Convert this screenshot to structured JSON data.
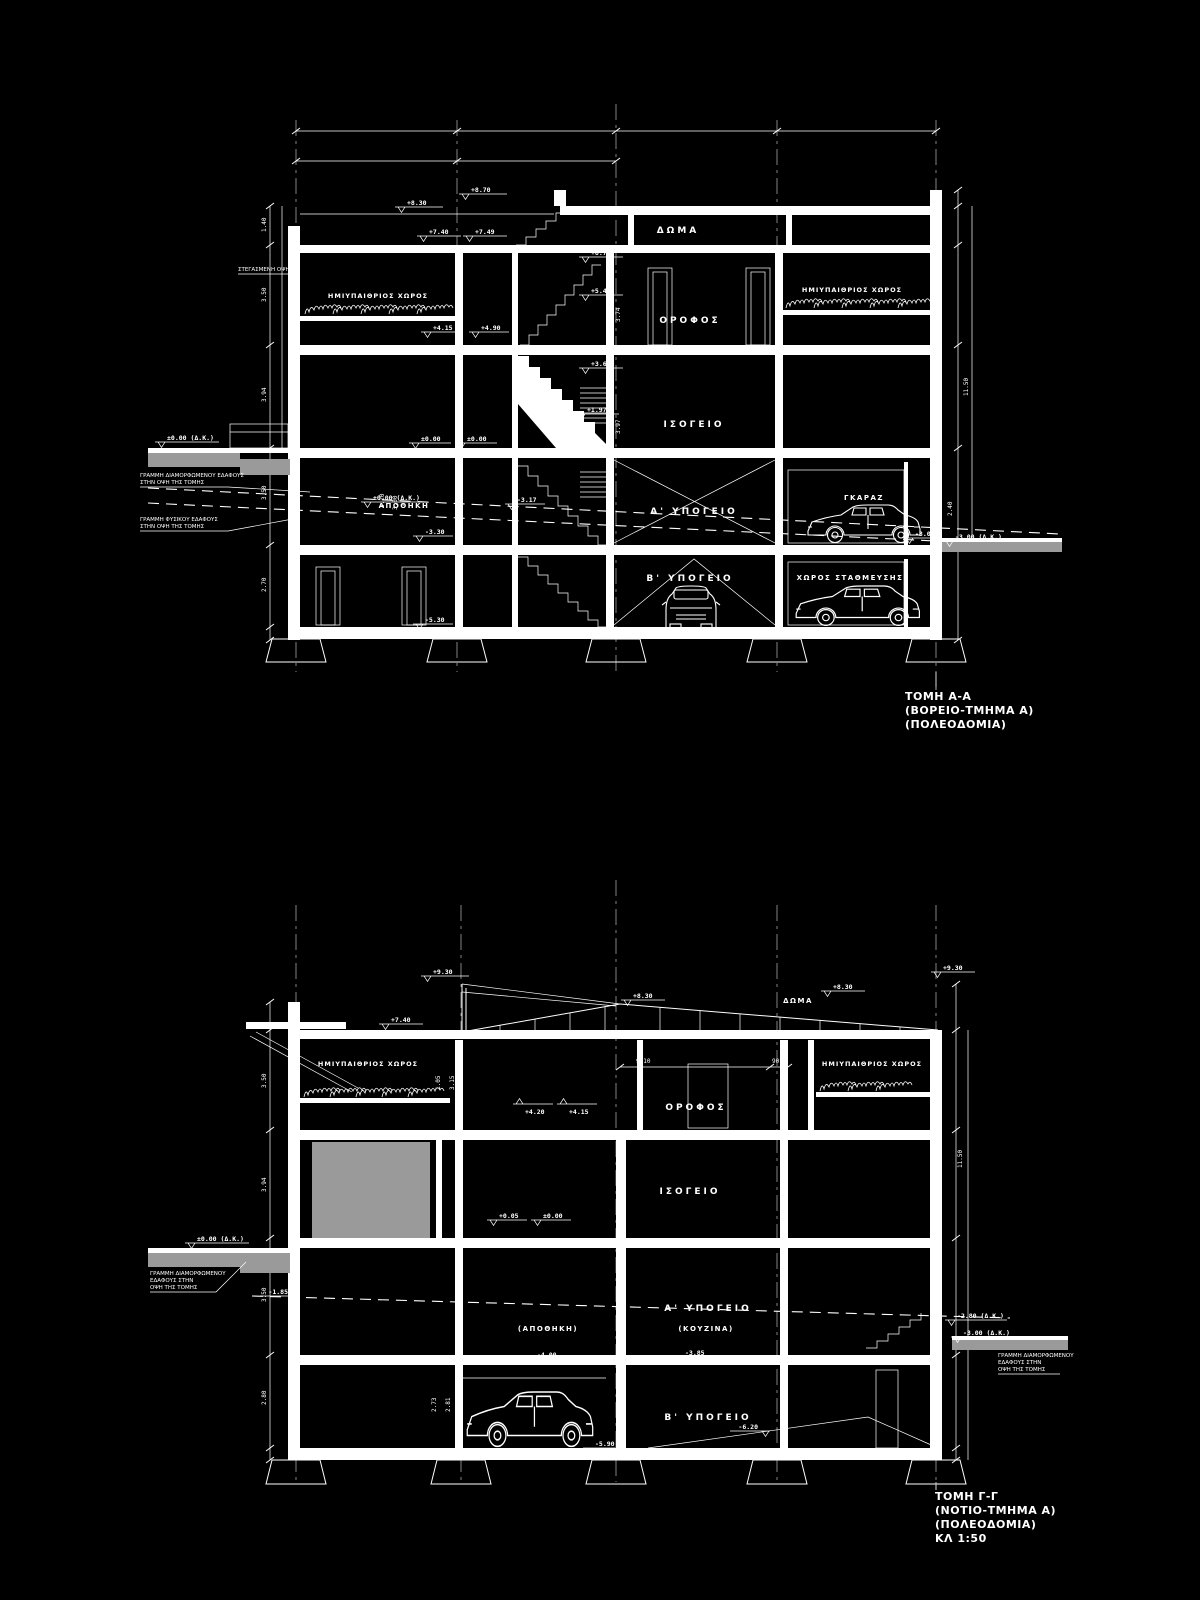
{
  "drawing": {
    "colors": {
      "background": "#000000",
      "line": "#ffffff",
      "gray": "#9a9a9a"
    },
    "section_a": {
      "title": [
        "ΤΟΜΗ Α-Α",
        "(ΒΟΡΕΙΟ-ΤΜΗΜΑ Α)",
        "(ΠΟΛΕΟΔΟΜΙΑ)"
      ],
      "labels": {
        "doma": "ΔΩΜΑ",
        "orofos": "ΟΡΟΦΟΣ",
        "isogeio": "ΙΣΟΓΕΙΟ",
        "ypogeio_a": "Α' ΥΠΟΓΕΙΟ",
        "ypogeio_b": "Β' ΥΠΟΓΕΙΟ",
        "apothiki": "ΑΠΟΘΗΚΗ",
        "garage": "ΓΚΑΡΑΖ",
        "parking": "ΧΩΡΟΣ ΣΤΑΘΜΕΥΣΗΣ",
        "semi_left": "ΗΜΙΥΠΑΙΘΡΙΟΣ ΧΩΡΟΣ",
        "semi_right": "ΗΜΙΥΠΑΙΘΡΙΟΣ ΧΩΡΟΣ",
        "covered_note": "ΣΤΕΓΑΣΜΕΝΗ ΟΨΗ"
      },
      "elev": {
        "p870": "+8.70",
        "p830": "+8.30",
        "p740": "+7.40",
        "p749": "+7.49",
        "p677": "+6.77",
        "p549": "+5.49",
        "p490": "+4.90",
        "p415": "+4.15",
        "p366": "+3.66",
        "p197": "+1.97",
        "z1": "±0.00",
        "z2": "±0.00",
        "zdk1": "±0.00 (Δ.Κ.)",
        "zdk2": "±0.00 (Δ.Κ.)",
        "m317": "-3.17",
        "m330": "-3.30",
        "m530": "-5.30",
        "m300": "-3.00",
        "m300dk": "-3.00 (Δ.Κ.)"
      },
      "dims": {
        "a": "3.74",
        "b": "3.97",
        "c": "3.00",
        "d": "3.20",
        "e": "3.00",
        "f": "2.40",
        "g": "11.50",
        "h": "1.40",
        "i": "3.50",
        "j": "3.94",
        "k": "3.50",
        "l": "2.70"
      },
      "ann": {
        "formed": [
          "ΓΡΑΜΜΗ ΔΙΑΜΟΡΦΩΜΕΝΟΥ ΕΔΑΦΟΥΣ",
          "ΣΤΗΝ ΟΨΗ ΤΗΣ ΤΟΜΗΣ"
        ],
        "natural": [
          "ΓΡΑΜΜΗ ΦΥΣΙΚΟΥ ΕΔΑΦΟΥΣ",
          "ΣΤΗΝ ΟΨΗ ΤΗΣ ΤΟΜΗΣ"
        ]
      }
    },
    "section_c": {
      "title": [
        "ΤΟΜΗ Γ-Γ",
        "(ΝΟΤΙΟ-ΤΜΗΜΑ Α)",
        "(ΠΟΛΕΟΔΟΜΙΑ)",
        "ΚΛ 1:50"
      ],
      "labels": {
        "doma": "ΔΩΜΑ",
        "orofos": "ΟΡΟΦΟΣ",
        "isogeio": "ΙΣΟΓΕΙΟ",
        "ypogeio_a": "Α' ΥΠΟΓΕΙΟ",
        "ypogeio_b": "Β' ΥΠΟΓΕΙΟ",
        "apothiki": "(ΑΠΟΘΗΚΗ)",
        "kouzina": "(ΚΟΥΖΙΝΑ)",
        "semi_left": "ΗΜΙΥΠΑΙΘΡΙΟΣ ΧΩΡΟΣ",
        "semi_right": "ΗΜΙΥΠΑΙΘΡΙΟΣ ΧΩΡΟΣ"
      },
      "elev": {
        "p930": "+9.30",
        "p830": "+8.30",
        "p830r": "+8.30",
        "p930r": "+9.30",
        "p740": "+7.40",
        "p420": "+4.20",
        "p415": "+4.15",
        "p005": "+0.05",
        "z1": "±0.00",
        "zdk": "±0.00 (Δ.Κ.)",
        "m185": "-1.85",
        "m400": "-4.00",
        "m385": "-3.85",
        "m280dk": "-2.80 (Δ.Κ.)",
        "m300dk": "-3.00 (Δ.Κ.)",
        "m620": "-6.20",
        "m590": "-5.90"
      },
      "dims": {
        "a": "9.10",
        "b": "90",
        "c": "1.05",
        "d": "3.15",
        "e": "2.73",
        "f": "2.81",
        "g": "11.50",
        "h": "3.50",
        "i": "3.94",
        "j": "3.50",
        "k": "2.80"
      },
      "ann": {
        "left": [
          "ΓΡΑΜΜΗ ΔΙΑΜΟΡΦΩΜΕΝΟΥ",
          "ΕΔΑΦΟΥΣ ΣΤΗΝ",
          "ΟΨΗ ΤΗΣ ΤΟΜΗΣ"
        ],
        "right": [
          "ΓΡΑΜΜΗ ΔΙΑΜΟΡΦΩΜΕΝΟΥ",
          "ΕΔΑΦΟΥΣ ΣΤΗΝ",
          "ΟΨΗ ΤΗΣ ΤΟΜΗΣ"
        ]
      }
    }
  }
}
